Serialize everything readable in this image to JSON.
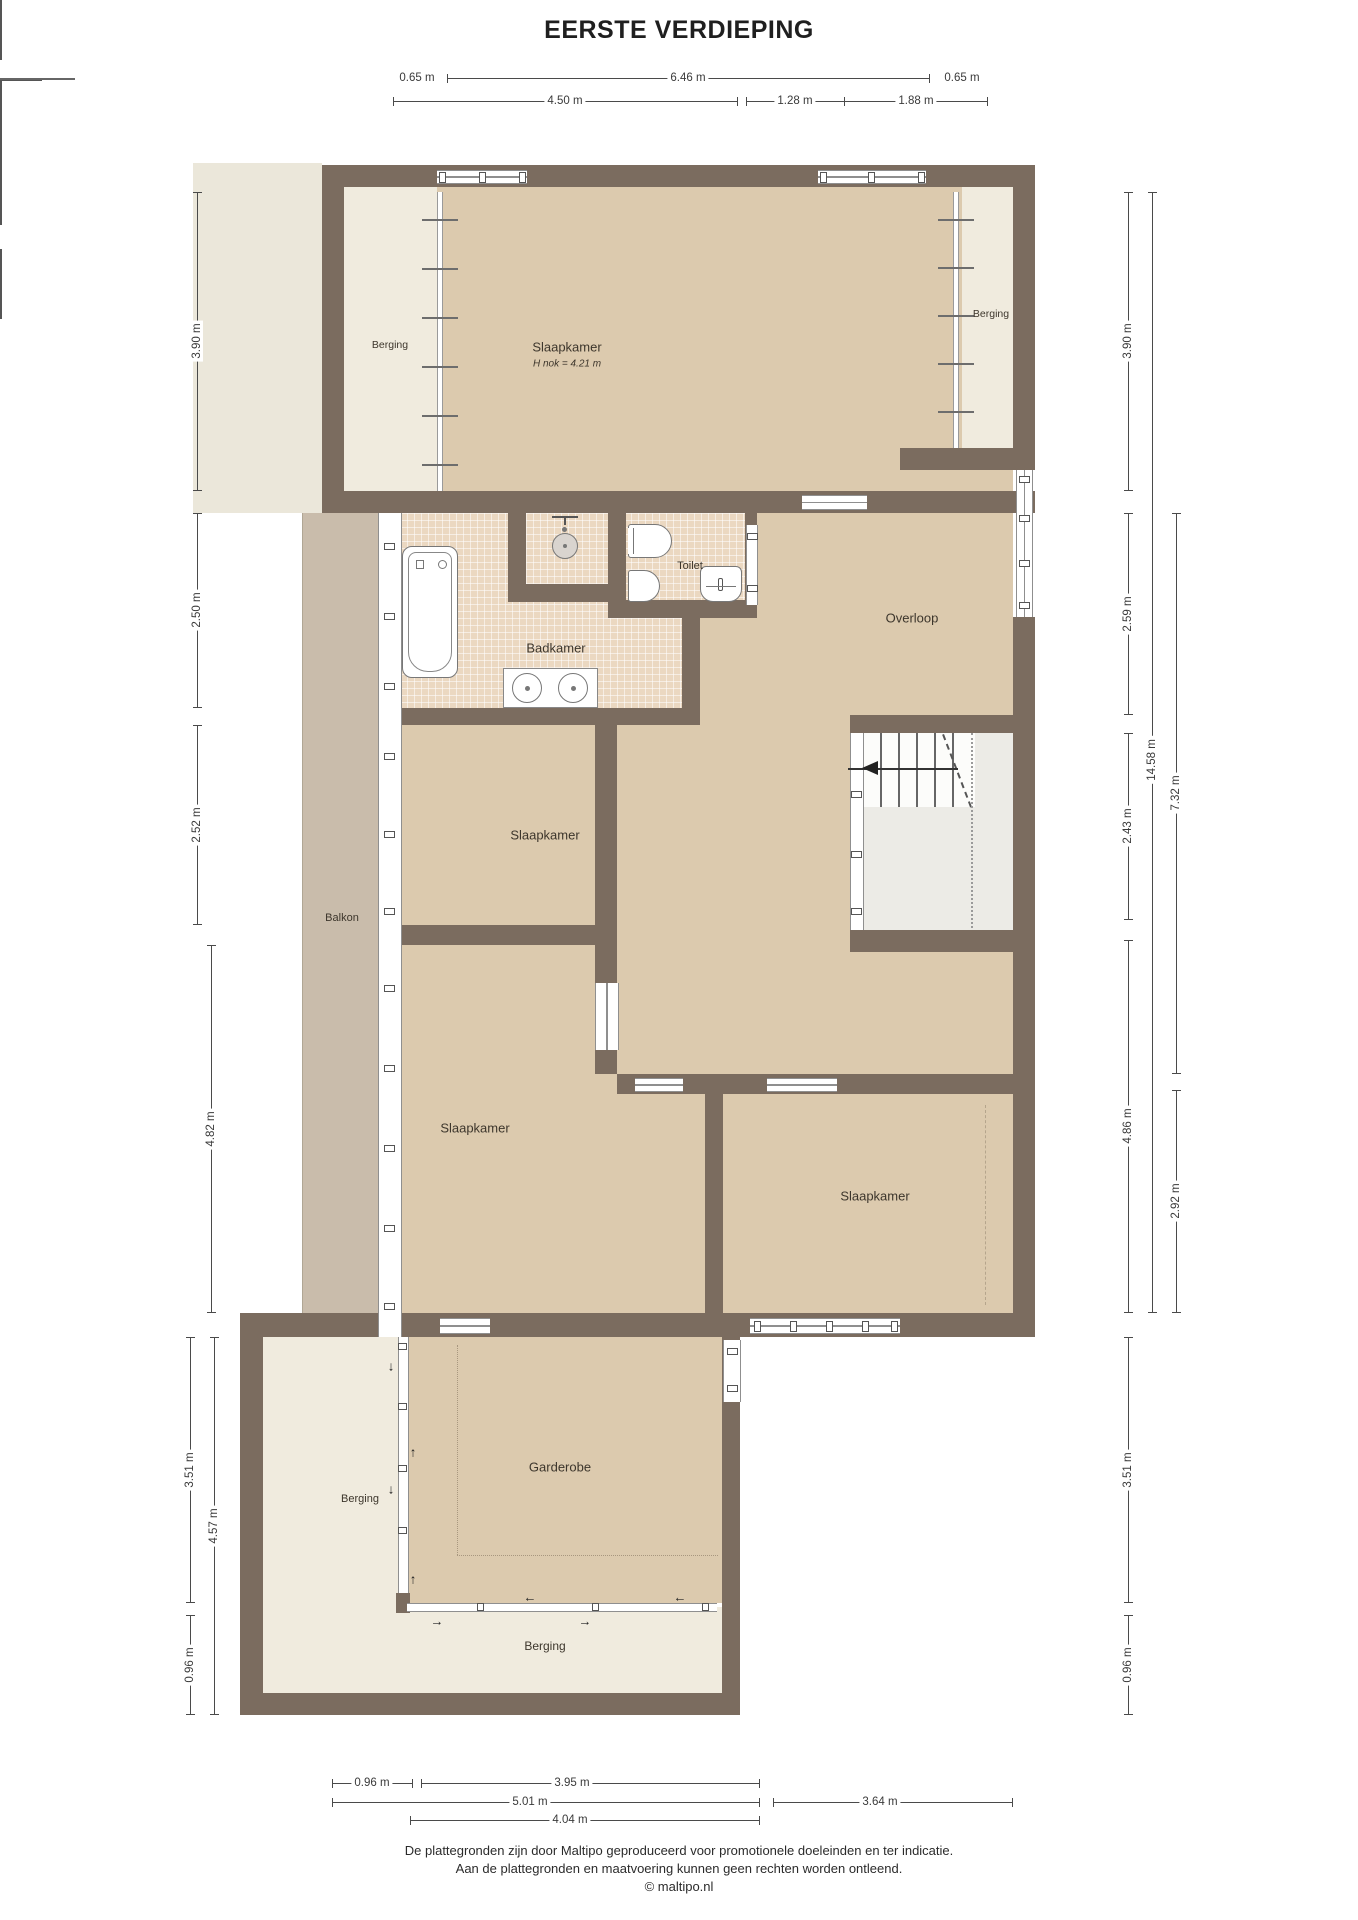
{
  "title": "EERSTE VERDIEPING",
  "rooms": {
    "slaapkamer_attic": {
      "name": "Slaapkamer",
      "note": "H nok = 4.21 m"
    },
    "berging_attic_left": {
      "name": "Berging"
    },
    "berging_attic_right": {
      "name": "Berging"
    },
    "badkamer": {
      "name": "Badkamer"
    },
    "toilet": {
      "name": "Toilet"
    },
    "overloop": {
      "name": "Overloop"
    },
    "balkon": {
      "name": "Balkon"
    },
    "slaapkamer_mid": {
      "name": "Slaapkamer"
    },
    "slaapkamer_big": {
      "name": "Slaapkamer"
    },
    "slaapkamer_right": {
      "name": "Slaapkamer"
    },
    "garderobe": {
      "name": "Garderobe"
    },
    "berging_bottom_left": {
      "name": "Berging"
    },
    "berging_bottom": {
      "name": "Berging"
    }
  },
  "dimensions": {
    "top_row1": [
      {
        "label": "0.65 m"
      },
      {
        "label": "6.46 m"
      },
      {
        "label": "0.65 m"
      }
    ],
    "top_row2": [
      {
        "label": "4.50 m"
      },
      {
        "label": "1.28 m"
      },
      {
        "label": "1.88 m"
      }
    ],
    "left": [
      {
        "label": "3.90 m"
      },
      {
        "label": "2.50 m"
      },
      {
        "label": "2.52 m"
      },
      {
        "label": "4.82 m"
      },
      {
        "label": "3.51 m"
      },
      {
        "label": "4.57 m"
      },
      {
        "label": "0.96 m"
      }
    ],
    "right": [
      {
        "label": "3.90 m"
      },
      {
        "label": "2.59 m"
      },
      {
        "label": "2.43 m"
      },
      {
        "label": "4.86 m"
      },
      {
        "label": "14.58 m"
      },
      {
        "label": "7.32 m"
      },
      {
        "label": "2.92 m"
      },
      {
        "label": "3.51 m"
      },
      {
        "label": "0.96 m"
      }
    ],
    "bottom": [
      {
        "label": "0.96 m"
      },
      {
        "label": "3.95 m"
      },
      {
        "label": "5.01 m"
      },
      {
        "label": "3.64 m"
      },
      {
        "label": "4.04 m"
      }
    ]
  },
  "icons": {
    "arrow_down": "↓",
    "arrow_up": "↑",
    "arrow_left": "←",
    "arrow_right": "→"
  },
  "footer": {
    "line1": "De plattegronden zijn door Maltipo geproduceerd voor promotionele doeleinden en ter indicatie.",
    "line2": "Aan de plattegronden en maatvoering kunnen geen rechten worden ontleend.",
    "line3": "© maltipo.nl"
  },
  "colors": {
    "wall": "#7b6c5f",
    "floor_tan": "#dccaae",
    "floor_cream": "#f0ebde",
    "tile": "#ebd8c1",
    "balkon": "#c9bcab",
    "outside": "#ebe7da"
  }
}
